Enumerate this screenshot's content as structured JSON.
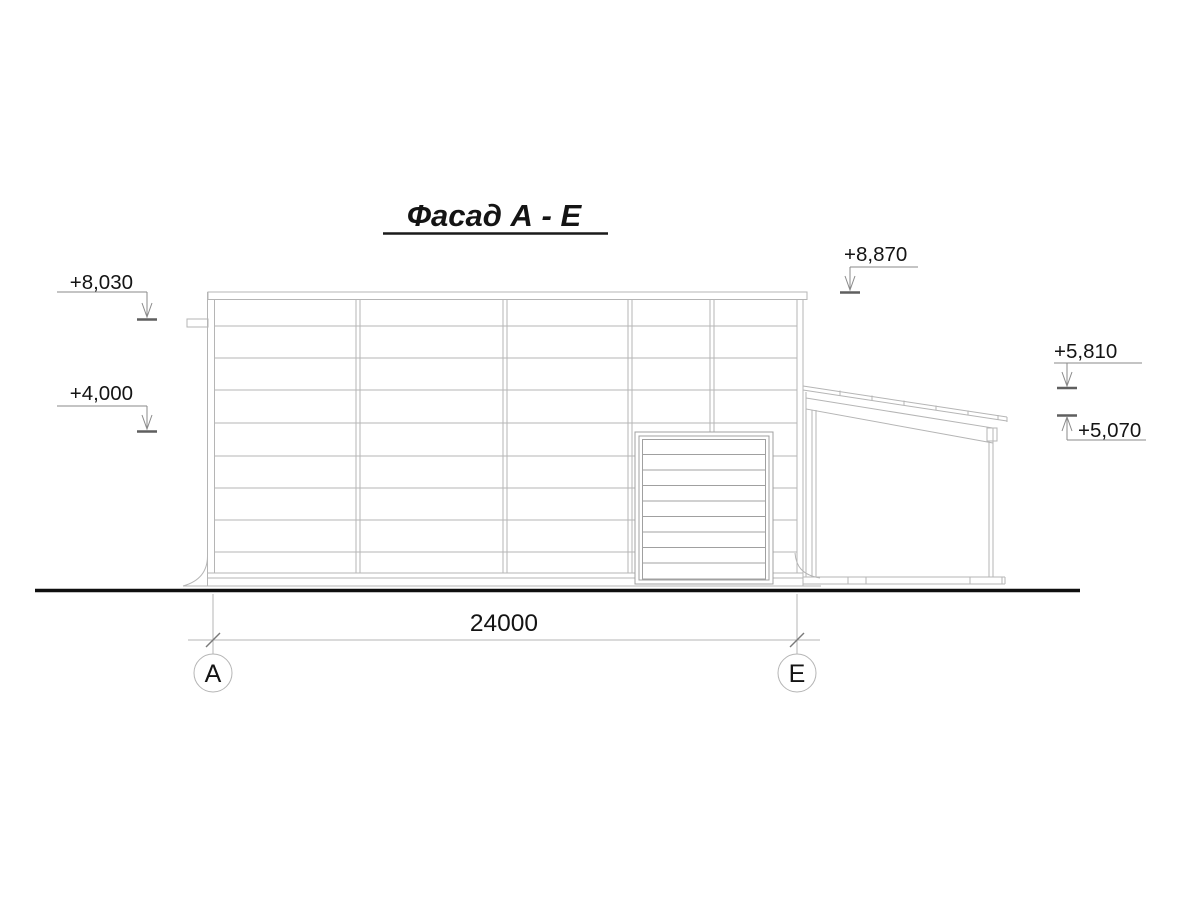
{
  "title": {
    "text": "Фасад А - Е"
  },
  "dimension": {
    "value": "24000"
  },
  "axes": {
    "left": "А",
    "right": "Е"
  },
  "elevation_marks": {
    "parapet_left": {
      "label": "+8,030"
    },
    "door_top": {
      "label": "+4,000"
    },
    "parapet_right": {
      "label": "+8,870"
    },
    "canopy_high": {
      "label": "+5,810"
    },
    "canopy_low": {
      "label": "+5,070"
    }
  },
  "colors": {
    "background": "#ffffff",
    "drawing_line": "#b5b5b5",
    "leader_line": "#8a8a8a",
    "level_tick": "#5f5f5f",
    "ground_line": "#0f0f0f",
    "text": "#141414"
  }
}
